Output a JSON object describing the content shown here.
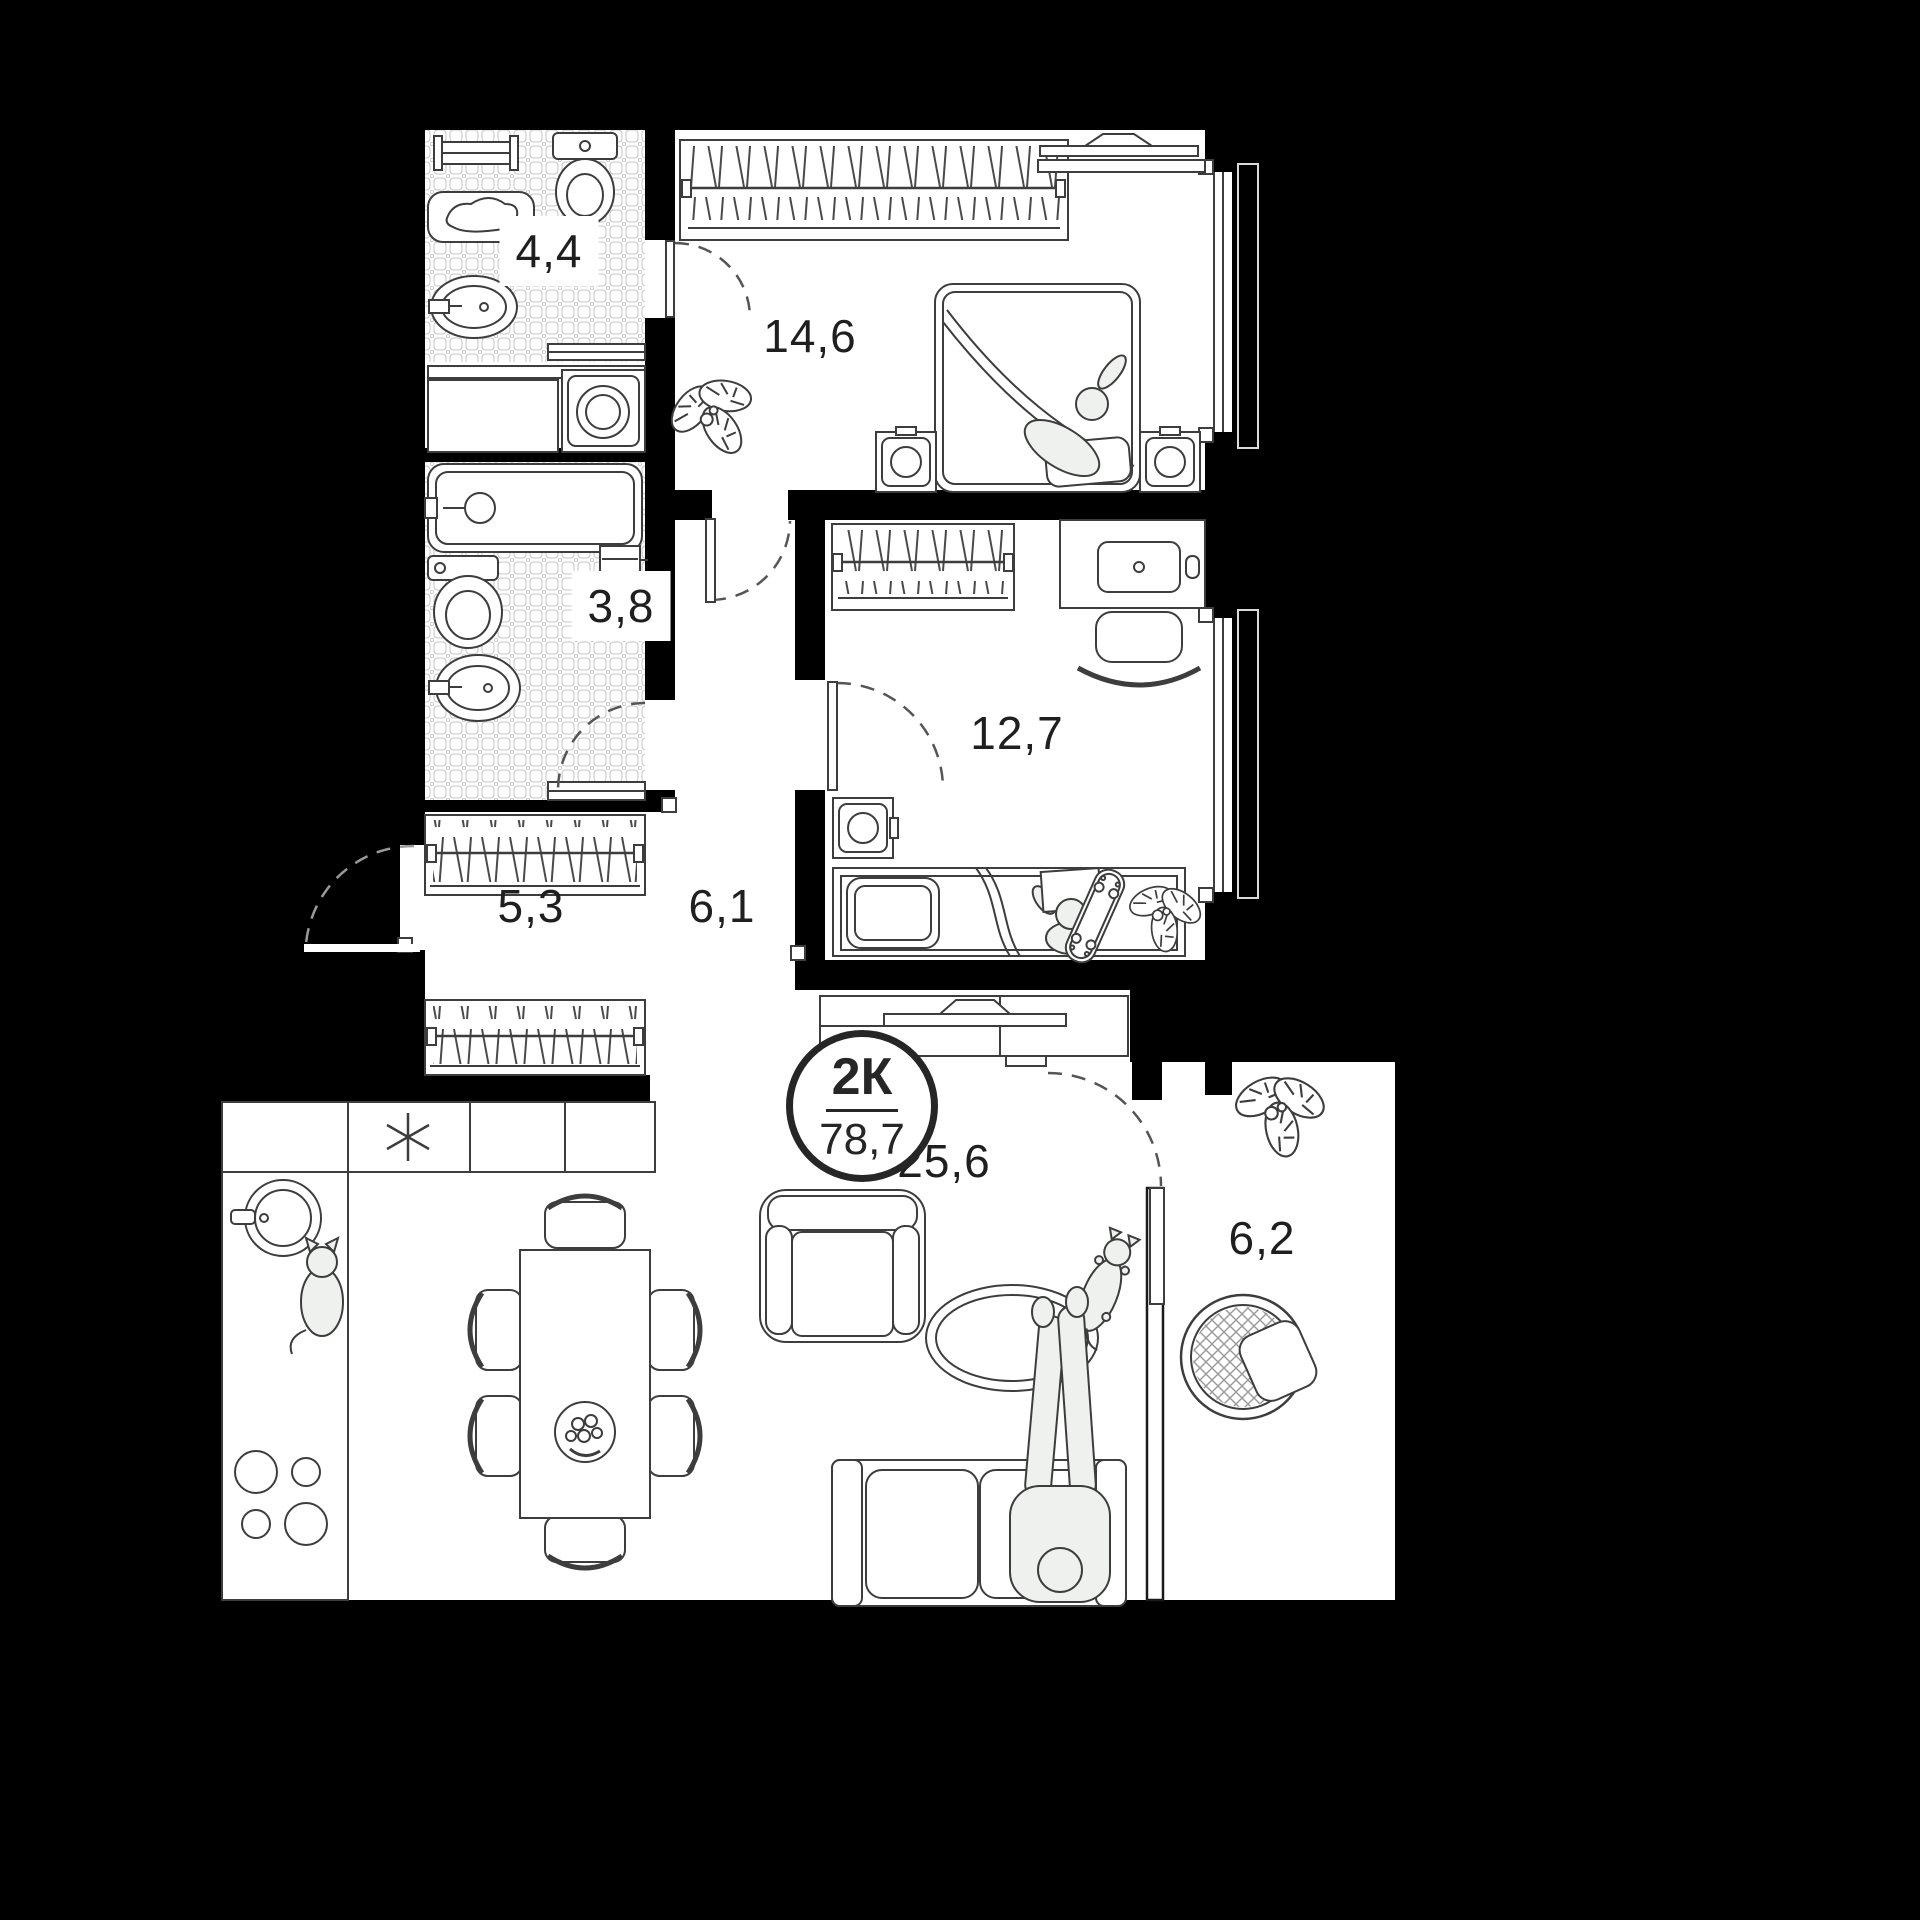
{
  "plan": {
    "badge": {
      "type_label": "2К",
      "area_label": "78,7"
    },
    "rooms": [
      {
        "id": "bathroom-small",
        "area_label": "4,4"
      },
      {
        "id": "bedroom-master",
        "area_label": "14,6"
      },
      {
        "id": "bathroom-large",
        "area_label": "3,8"
      },
      {
        "id": "bedroom-second",
        "area_label": "12,7"
      },
      {
        "id": "hallway",
        "area_label": "5,3"
      },
      {
        "id": "corridor",
        "area_label": "6,1"
      },
      {
        "id": "living-kitchen",
        "area_label": "25,6"
      },
      {
        "id": "balcony",
        "area_label": "6,2"
      }
    ],
    "colors": {
      "background": "#000000",
      "floor": "#ffffff",
      "line": "#3d3d3d",
      "figure_fill": "#eef1ed",
      "badge_ring": "#262626"
    }
  }
}
